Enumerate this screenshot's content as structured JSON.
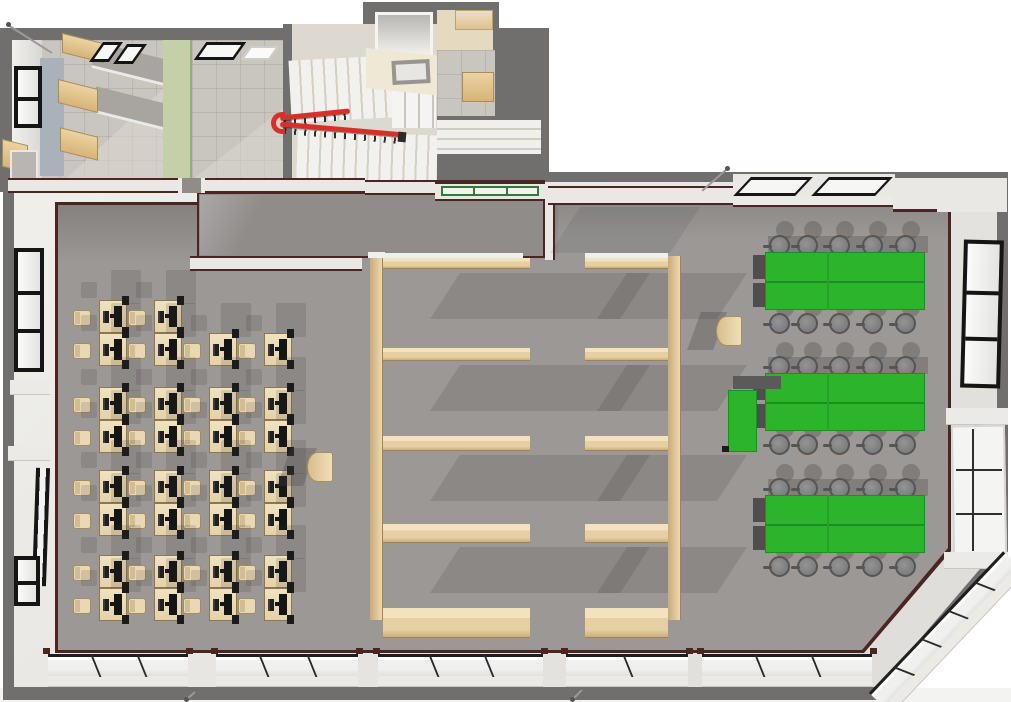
{
  "scene": {
    "kind": "3d-floor-plan-render",
    "view": "top-down perspective of one building storey",
    "width_px": 1011,
    "height_px": 702,
    "visible_text": "none"
  },
  "palette": {
    "exterior_shell": "#716e6e",
    "wall_face": "#e9e8e5",
    "wall_cut_line": "#4a2521",
    "floor_main": "#9b9896",
    "floor_corridor": "#8f8c8a",
    "floor_tile": "#c9c5bf",
    "green_wall": "#c5cfa8",
    "wood": "#e7cfa4",
    "desk_beige": "#eddcb9",
    "table_green": "#2cb52c",
    "stool_gray": "#7f7f7f",
    "stair_rail_red": "#d63129",
    "window_frame": "#151515",
    "glass": "#f4f4f3"
  },
  "zones": {
    "annex_rooms": [
      "office-with-wall-cabinets",
      "room-with-green-wall",
      "stairwell-with-red-railing",
      "entry-vestibule-with-skylight",
      "shaft-room"
    ],
    "corridor": "top-corridor",
    "main_hall_areas": [
      "computer-workstation-zone",
      "wooden-partition-bays",
      "green-table-seating-zone"
    ]
  },
  "workstations": {
    "desk_count": 30,
    "desk_w": 28,
    "desk_h": 33,
    "columns_x": [
      99,
      154,
      209,
      264
    ],
    "row_groups": [
      {
        "y": 300,
        "cells": [
          "pair",
          "pair",
          "single",
          "single"
        ]
      },
      {
        "y": 387,
        "cells": [
          "pair",
          "pair",
          "pair",
          "pair"
        ]
      },
      {
        "y": 470,
        "cells": [
          "pair",
          "pair",
          "pair",
          "pair"
        ]
      },
      {
        "y": 555,
        "cells": [
          "pair",
          "pair",
          "pair",
          "pair"
        ]
      }
    ]
  },
  "green_tables": {
    "groups": [
      {
        "x": 765,
        "y": 252
      },
      {
        "x": 765,
        "y": 373
      },
      {
        "x": 765,
        "y": 495
      }
    ],
    "table_w_left": 62,
    "table_w_right": 96,
    "table_h": 58,
    "stools_per_side": 5,
    "stool_cx_offsets": [
      14,
      42,
      74,
      107,
      140
    ],
    "side_table": {
      "x": 728,
      "y": 390,
      "w": 29,
      "h": 62,
      "group_index": 1
    },
    "back_panels_per_group": 2
  },
  "shelving": {
    "board_ys": [
      258,
      348,
      436,
      524,
      608
    ],
    "board_heights": [
      11,
      13,
      15,
      19,
      30
    ],
    "left_unit": {
      "wall_x": 370,
      "board_x": 383,
      "board_w": 147
    },
    "right_unit": {
      "wall_x": 668,
      "board_x": 585,
      "board_w": 83
    }
  },
  "stairwell": {
    "flights": 2,
    "rail_color": "#d63129",
    "balusters": "dark-metal"
  },
  "podiums": [
    {
      "x": 307,
      "y": 452
    },
    {
      "x": 716,
      "y": 316
    }
  ],
  "window_bands": {
    "bottom_segments": [
      {
        "x": 48,
        "w": 140,
        "mullions": 2
      },
      {
        "x": 216,
        "w": 142,
        "mullions": 2
      },
      {
        "x": 378,
        "w": 165,
        "mullions": 2
      },
      {
        "x": 566,
        "w": 122,
        "mullions": 1
      },
      {
        "x": 702,
        "w": 170,
        "mullions": 2
      }
    ],
    "chamfer": {
      "x": 866,
      "y": 690,
      "len": 195,
      "angle_deg": -46.5,
      "mullions": 4
    },
    "right_lower": {
      "x": 952,
      "y": 425,
      "w": 54,
      "h": 130
    },
    "right_upper": {
      "x": 962,
      "y": 240,
      "w": 40,
      "h": 148,
      "panes": 3
    },
    "left_upper": {
      "x": 14,
      "y": 248,
      "w": 30,
      "h": 124,
      "panes": 3
    },
    "left_bottom": {
      "x": 14,
      "y": 556,
      "w": 26,
      "h": 50,
      "panes": 2
    },
    "clerestory_panes": [
      {
        "x": 742,
        "y": 177,
        "w": 62,
        "h": 19
      },
      {
        "x": 820,
        "y": 177,
        "w": 64,
        "h": 19
      }
    ],
    "green_window": {
      "x": 441,
      "y": 186,
      "w": 98,
      "h": 10,
      "frame_color": "#2e7d32"
    }
  },
  "markers": {
    "pins": [
      {
        "x": 6,
        "y": 22,
        "dx": 44,
        "dy": 28
      },
      {
        "x": 725,
        "y": 166,
        "dx": -25,
        "dy": 22
      },
      {
        "x": 570,
        "y": 697,
        "dx": 10,
        "dy": -10
      },
      {
        "x": 184,
        "y": 697,
        "dx": 9,
        "dy": -8
      }
    ]
  }
}
